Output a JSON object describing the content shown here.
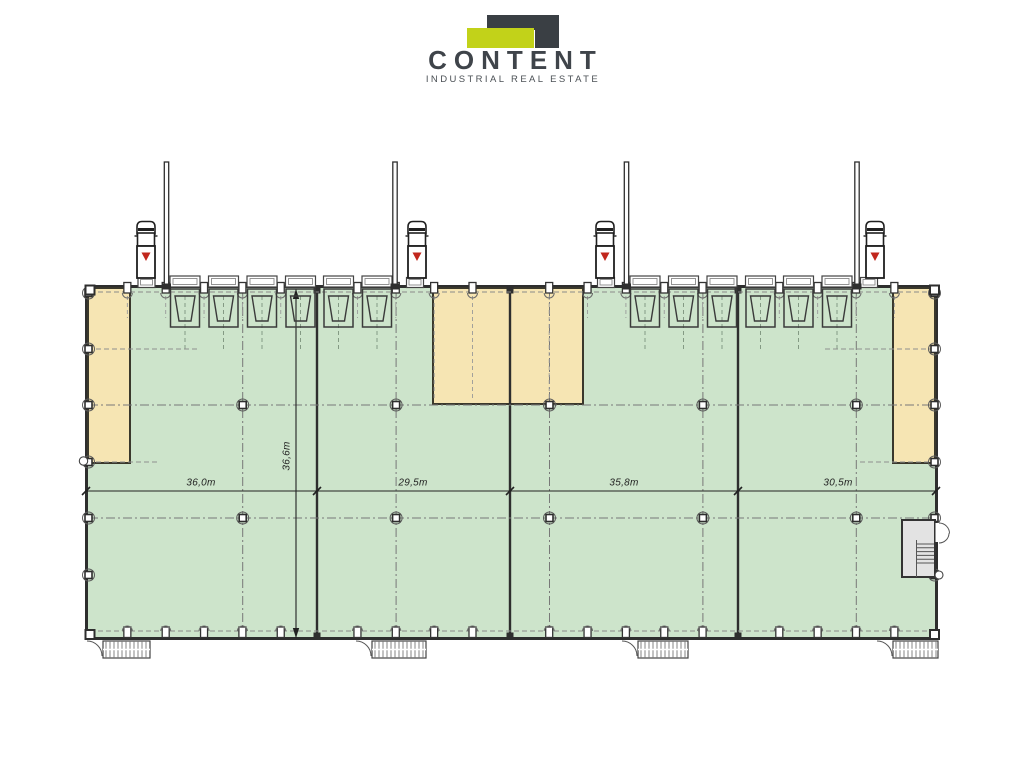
{
  "logo": {
    "title": "CONTENT",
    "subtitle": "INDUSTRIAL REAL ESTATE"
  },
  "plan": {
    "type": "industrial warehouse floor plan",
    "unit_widths": [
      "36,0m",
      "29,5m",
      "35,8m",
      "30,5m"
    ],
    "depth_label": "36,6m",
    "units_count": 4,
    "dock_doors_count": 12,
    "trucks_count": 4,
    "office_areas_count": 3
  },
  "colors": {
    "floor_green": "#cde4cb",
    "office_tan": "#f6e5b3",
    "wall": "#2e2e2e",
    "outline_dark": "#3a382c",
    "logo_green": "#c2d219",
    "logo_dark": "#3a3f44",
    "marker_red": "#c1271d",
    "room_gray": "#e3e3e3",
    "dash_gray": "#8a8a8a"
  },
  "icons": {
    "truck": "truck-icon",
    "dock_leveler": "dock-leveler-icon",
    "stairs": "stairs-icon",
    "column": "column-marker"
  }
}
